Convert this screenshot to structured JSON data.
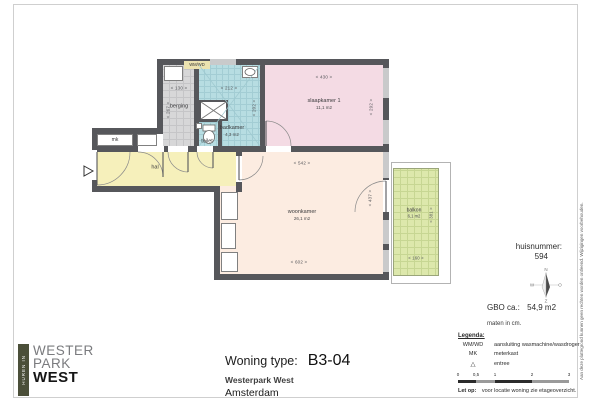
{
  "page": {
    "disclaimer": "Aan deze plattegrond kunnen geen rechten worden ontleend. Wijzigingen voorbehouden."
  },
  "logo": {
    "tab": "HUREN IN",
    "line1": "WESTER",
    "line2": "PARK",
    "line3": "WEST"
  },
  "title_block": {
    "label": "Woning type:",
    "value": "B3-04",
    "project": "Westerpark West",
    "city": "Amsterdam"
  },
  "info": {
    "huisnummer_label": "huisnummer:",
    "huisnummer_value": "594",
    "gbo_label": "GBO ca.:",
    "gbo_value": "54,9 m2",
    "units_note": "maten in cm.",
    "compass": {
      "north": "N",
      "east": "O",
      "south": "Z",
      "west": "W"
    }
  },
  "legend": {
    "heading": "Legenda:",
    "items": [
      {
        "key": "WM/WD",
        "label": "aansluiting wasmachine/wasdroger"
      },
      {
        "key": "MK",
        "label": "meterkast"
      },
      {
        "key": "△",
        "label": "entree"
      }
    ],
    "scale_ticks": [
      "0",
      "0,5",
      "1",
      "2",
      "3"
    ],
    "note_label": "Let op:",
    "note": "voor locatie woning zie etageoverzicht."
  },
  "plan": {
    "labels": {
      "wmwd": "WM/WD"
    },
    "rooms": {
      "berging": {
        "name": "berging",
        "dim_w": "< 130 >",
        "dim_h": "< 267 >"
      },
      "badkamer": {
        "name": "badkamer",
        "area": "4,3 m2",
        "dim_w": "< 212 >",
        "dim_h": "< 202 >"
      },
      "toilet": {
        "name": "toilet"
      },
      "slaapkamer1": {
        "name": "slaapkamer 1",
        "area": "11,1 m2",
        "dim_w": "< 430 >",
        "dim_h": "< 292 >"
      },
      "woonkamer": {
        "name": "woonkamer",
        "area": "26,1 m2",
        "dim_w_top": "< 542 >",
        "dim_w_bottom": "< 602 >",
        "dim_h": "< 437 >"
      },
      "hal": {
        "name": "hal"
      },
      "mk": {
        "name": "mk"
      },
      "balkon": {
        "name": "balkon",
        "area": "6,1 m2",
        "dim_w": "< 160 >",
        "dim_h": "< 381 >"
      }
    }
  },
  "colors": {
    "wall": "#56575b",
    "berging_fill": "#d7d7d8",
    "badkamer_fill": "#b7dde2",
    "slaapkamer_fill": "#f4dbe4",
    "woonkamer_fill": "#fcece1",
    "hal_fill": "#f6f0bb",
    "balkon_fill": "#dde8ac",
    "logo_bar": "#4b4f39"
  }
}
